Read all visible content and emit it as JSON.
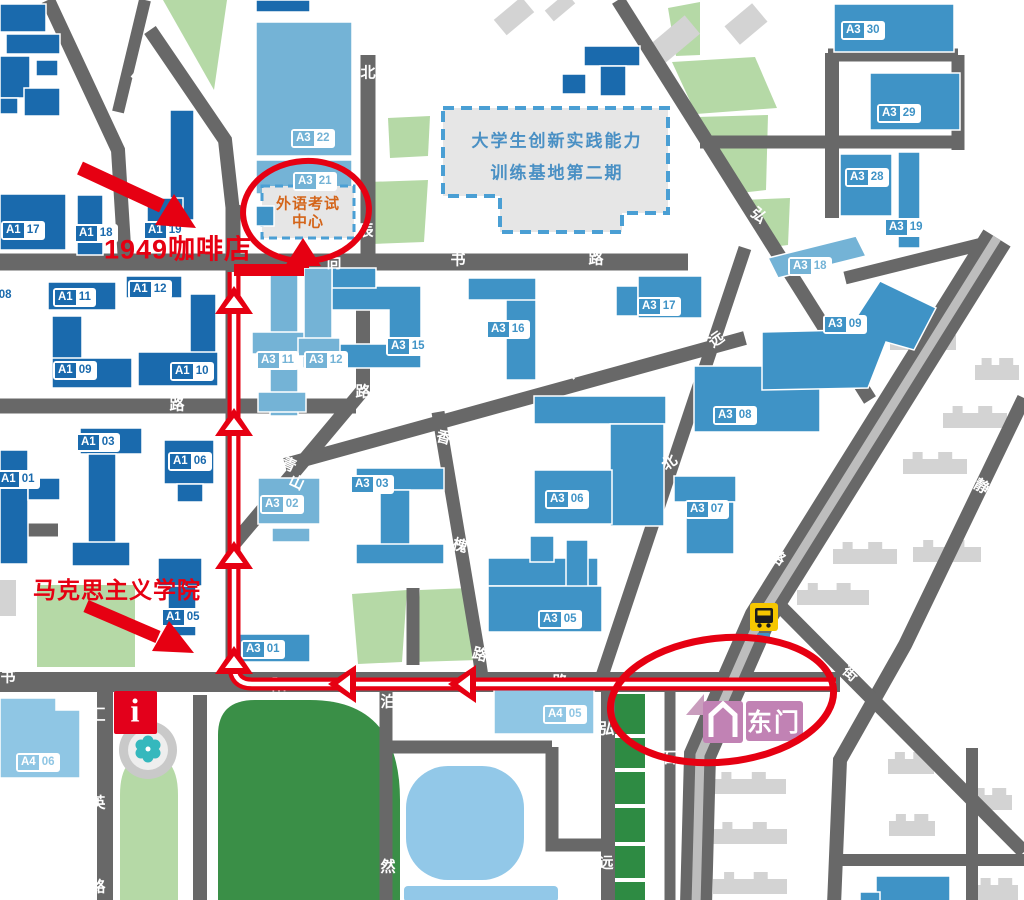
{
  "annotations": {
    "cafe": "1949咖啡店",
    "marx": "马克思主义学院",
    "exam_line1": "外语考试",
    "exam_line2": "中心",
    "base_line1": "大学生创新实践能力",
    "base_line2": "训练基地第二期",
    "east_gate": "东门",
    "info": "i"
  },
  "colors": {
    "route_red": "#e60012",
    "road_gray": "#686868",
    "building_dark_blue": "#1a6aad",
    "building_medium_blue": "#3f93c6",
    "building_light_blue": "#74b3d6",
    "building_a4_blue": "#8fc6e4",
    "green_light": "#b5d9a6",
    "green_dark": "#3a8f47",
    "pond_blue": "#92c8e8",
    "gate_pink": "#c182b4",
    "bus_yellow": "#f6c700",
    "exam_orange": "#d4651a",
    "base_text_blue": "#4a90c4"
  },
  "buildings": [
    {
      "p": "A1",
      "n": "17",
      "v": "dark",
      "x": 1,
      "y": 221
    },
    {
      "p": "A1",
      "n": "18",
      "v": "dark",
      "x": 74,
      "y": 224
    },
    {
      "p": "A1",
      "n": "19",
      "v": "dark",
      "x": 143,
      "y": 221
    },
    {
      "p": "A1",
      "n": "11",
      "v": "dark",
      "x": 53,
      "y": 288
    },
    {
      "p": "A1",
      "n": "12",
      "v": "dark",
      "x": 128,
      "y": 280
    },
    {
      "p": "A1",
      "n": "09",
      "v": "dark",
      "x": 53,
      "y": 361
    },
    {
      "p": "A1",
      "n": "10",
      "v": "dark",
      "x": 170,
      "y": 362
    },
    {
      "p": "A1",
      "n": "08",
      "v": "dark",
      "x": -27,
      "y": 286
    },
    {
      "p": "A1",
      "n": "03",
      "v": "dark",
      "x": 76,
      "y": 433
    },
    {
      "p": "A1",
      "n": "06",
      "v": "dark",
      "x": 168,
      "y": 452
    },
    {
      "p": "A1",
      "n": "01",
      "v": "dark",
      "x": -4,
      "y": 470
    },
    {
      "p": "A1",
      "n": "05",
      "v": "dark",
      "x": 161,
      "y": 608
    },
    {
      "p": "A3",
      "n": "30",
      "v": "med",
      "x": 841,
      "y": 21
    },
    {
      "p": "A3",
      "n": "29",
      "v": "med",
      "x": 877,
      "y": 104
    },
    {
      "p": "A3",
      "n": "28",
      "v": "med",
      "x": 845,
      "y": 168
    },
    {
      "p": "A3",
      "n": "19",
      "v": "med",
      "x": 884,
      "y": 218
    },
    {
      "p": "A3",
      "n": "17",
      "v": "med",
      "x": 637,
      "y": 297
    },
    {
      "p": "A3",
      "n": "16",
      "v": "med",
      "x": 486,
      "y": 320
    },
    {
      "p": "A3",
      "n": "15",
      "v": "med",
      "x": 386,
      "y": 337
    },
    {
      "p": "A3",
      "n": "09",
      "v": "med",
      "x": 823,
      "y": 315
    },
    {
      "p": "A3",
      "n": "08",
      "v": "med",
      "x": 713,
      "y": 406
    },
    {
      "p": "A3",
      "n": "07",
      "v": "med",
      "x": 685,
      "y": 500
    },
    {
      "p": "A3",
      "n": "06",
      "v": "med",
      "x": 545,
      "y": 490
    },
    {
      "p": "A3",
      "n": "05",
      "v": "med",
      "x": 538,
      "y": 610
    },
    {
      "p": "A3",
      "n": "03",
      "v": "med",
      "x": 350,
      "y": 475
    },
    {
      "p": "A3",
      "n": "01",
      "v": "med",
      "x": 241,
      "y": 640
    },
    {
      "p": "A3",
      "n": "22",
      "v": "light",
      "x": 291,
      "y": 129
    },
    {
      "p": "A3",
      "n": "21",
      "v": "light",
      "x": 293,
      "y": 172
    },
    {
      "p": "A3",
      "n": "11",
      "v": "light",
      "x": 256,
      "y": 351
    },
    {
      "p": "A3",
      "n": "12",
      "v": "light",
      "x": 304,
      "y": 351
    },
    {
      "p": "A3",
      "n": "02",
      "v": "light",
      "x": 260,
      "y": 495
    },
    {
      "p": "A3",
      "n": "18",
      "v": "light",
      "x": 788,
      "y": 257
    },
    {
      "p": "A4",
      "n": "05",
      "v": "a4",
      "x": 543,
      "y": 705
    },
    {
      "p": "A4",
      "n": "06",
      "v": "a4",
      "x": 16,
      "y": 753
    }
  ],
  "road_labels": [
    {
      "c": "路",
      "x": 140,
      "y": 76,
      "r": -50
    },
    {
      "c": "明",
      "x": 226,
      "y": 110,
      "r": -30
    },
    {
      "c": "北",
      "x": 368,
      "y": 72,
      "r": 0
    },
    {
      "c": "行",
      "x": 524,
      "y": 44,
      "r": -45
    },
    {
      "c": "辰",
      "x": 366,
      "y": 230,
      "r": 0
    },
    {
      "c": "向",
      "x": 334,
      "y": 262,
      "r": 0
    },
    {
      "c": "书",
      "x": 458,
      "y": 259,
      "r": 0
    },
    {
      "c": "路",
      "x": 596,
      "y": 258,
      "r": 0
    },
    {
      "c": "德",
      "x": 242,
      "y": 280,
      "r": 0
    },
    {
      "c": "路",
      "x": 237,
      "y": 447,
      "r": 0
    },
    {
      "c": "路",
      "x": 177,
      "y": 404,
      "r": 0
    },
    {
      "c": "青",
      "x": 289,
      "y": 464,
      "r": 25
    },
    {
      "c": "山",
      "x": 297,
      "y": 482,
      "r": 25
    },
    {
      "c": "香",
      "x": 444,
      "y": 437,
      "r": 15
    },
    {
      "c": "槐",
      "x": 460,
      "y": 545,
      "r": 15
    },
    {
      "c": "路",
      "x": 480,
      "y": 654,
      "r": 15
    },
    {
      "c": "泊",
      "x": 388,
      "y": 701,
      "r": 0
    },
    {
      "c": "阳",
      "x": 279,
      "y": 684,
      "r": 0
    },
    {
      "c": "路",
      "x": 560,
      "y": 681,
      "r": 0
    },
    {
      "c": "书",
      "x": 8,
      "y": 676,
      "r": 0
    },
    {
      "c": "汇",
      "x": 98,
      "y": 714,
      "r": 0
    },
    {
      "c": "英",
      "x": 98,
      "y": 802,
      "r": 0
    },
    {
      "c": "路",
      "x": 98,
      "y": 886,
      "r": 0
    },
    {
      "c": "然",
      "x": 388,
      "y": 866,
      "r": 0
    },
    {
      "c": "大",
      "x": 570,
      "y": 371,
      "r": 20
    },
    {
      "c": "路",
      "x": 363,
      "y": 391,
      "r": 0
    },
    {
      "c": "北",
      "x": 669,
      "y": 462,
      "r": -35
    },
    {
      "c": "远",
      "x": 716,
      "y": 339,
      "r": -35
    },
    {
      "c": "弘",
      "x": 759,
      "y": 215,
      "r": 40
    },
    {
      "c": "五",
      "x": 991,
      "y": 296,
      "r": 33
    },
    {
      "c": "一",
      "x": 891,
      "y": 497,
      "r": 33
    },
    {
      "c": "路",
      "x": 778,
      "y": 557,
      "r": 33
    },
    {
      "c": "静",
      "x": 982,
      "y": 486,
      "r": 30
    },
    {
      "c": "街",
      "x": 851,
      "y": 673,
      "r": 42
    },
    {
      "c": "石",
      "x": 669,
      "y": 757,
      "r": 0
    },
    {
      "c": "弘",
      "x": 607,
      "y": 728,
      "r": 0
    },
    {
      "c": "远",
      "x": 606,
      "y": 862,
      "r": 0
    }
  ]
}
